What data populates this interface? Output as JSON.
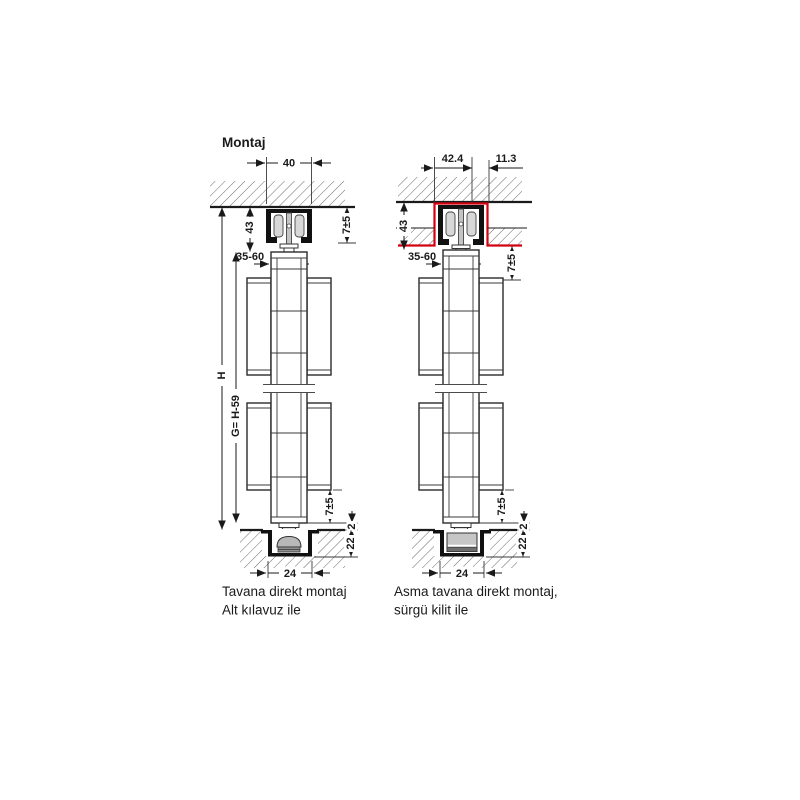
{
  "title": "Montaj",
  "colors": {
    "line": "#1a1a1a",
    "highlight_red": "#d40010",
    "track_black": "#111111",
    "roller_gray": "#d8d8d8",
    "guide_gray": "#c6c6c6"
  },
  "fig1": {
    "caption1": "Tavana direkt montaj",
    "caption2": "Alt kılavuz ile",
    "dim_track_width": "40",
    "dim_track_height": "43",
    "dim_top_adjust": "7±5",
    "dim_door_thickness": "35-60",
    "dim_total_height": "H",
    "dim_door_height": "G= H-59",
    "dim_bottom_adjust": "7±5",
    "dim_floor_gap": "2",
    "dim_channel_depth": "22",
    "dim_channel_width": "24"
  },
  "fig2": {
    "caption1": "Asma tavana direkt montaj,",
    "caption2": "sürgü kilit ile",
    "dim_recess_width": "42.4",
    "dim_recess_offset": "11.3",
    "dim_track_height": "43",
    "dim_top_adjust": "7±5",
    "dim_door_thickness": "35-60",
    "dim_bottom_adjust": "7±5",
    "dim_floor_gap": "2",
    "dim_channel_depth": "22",
    "dim_channel_width": "24"
  }
}
